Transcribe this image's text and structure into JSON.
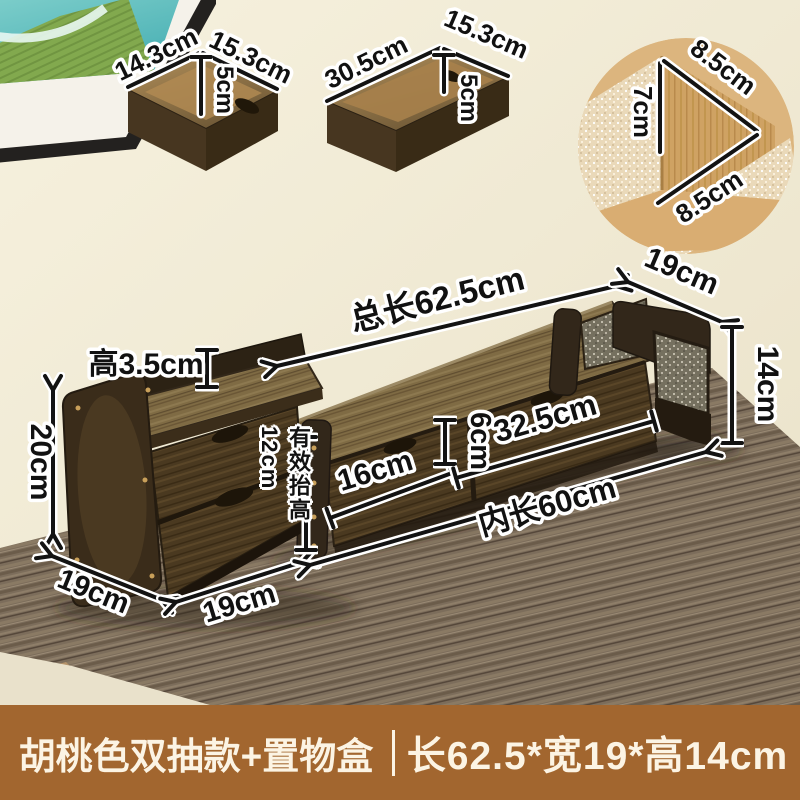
{
  "ann": {
    "box_small": {
      "w": "14.3cm",
      "d": "15.3cm",
      "h": "5cm"
    },
    "box_long": {
      "w": "30.5cm",
      "d": "15.3cm",
      "h": "5cm"
    },
    "corner_inset": {
      "top": "8.5cm",
      "height": "7cm",
      "bottom": "8.5cm"
    },
    "stand": {
      "total": "总长62.5cm",
      "depth": "19cm",
      "rail": "高3.5cm",
      "height_right": "14cm",
      "height_left": "20cm",
      "left_depth": "19cm",
      "left_width": "19cm",
      "riser": "有效抬高12cm",
      "left_drawer": "16cm",
      "gap": "6cm",
      "right_drawer": "32.5cm",
      "inner": "内长60cm"
    }
  },
  "banner": {
    "title": "胡桃色双抽款+置物盒",
    "size": "长62.5*宽19*高14cm"
  },
  "colors": {
    "banner_bg": "#a2662f",
    "banner_text": "#fcf4e4",
    "wall": "#f2ecd8",
    "annotation": "#111111",
    "wood_dark": "#4a3920",
    "wood_top": "#7f6b44",
    "desk": "#7c6d5b"
  }
}
